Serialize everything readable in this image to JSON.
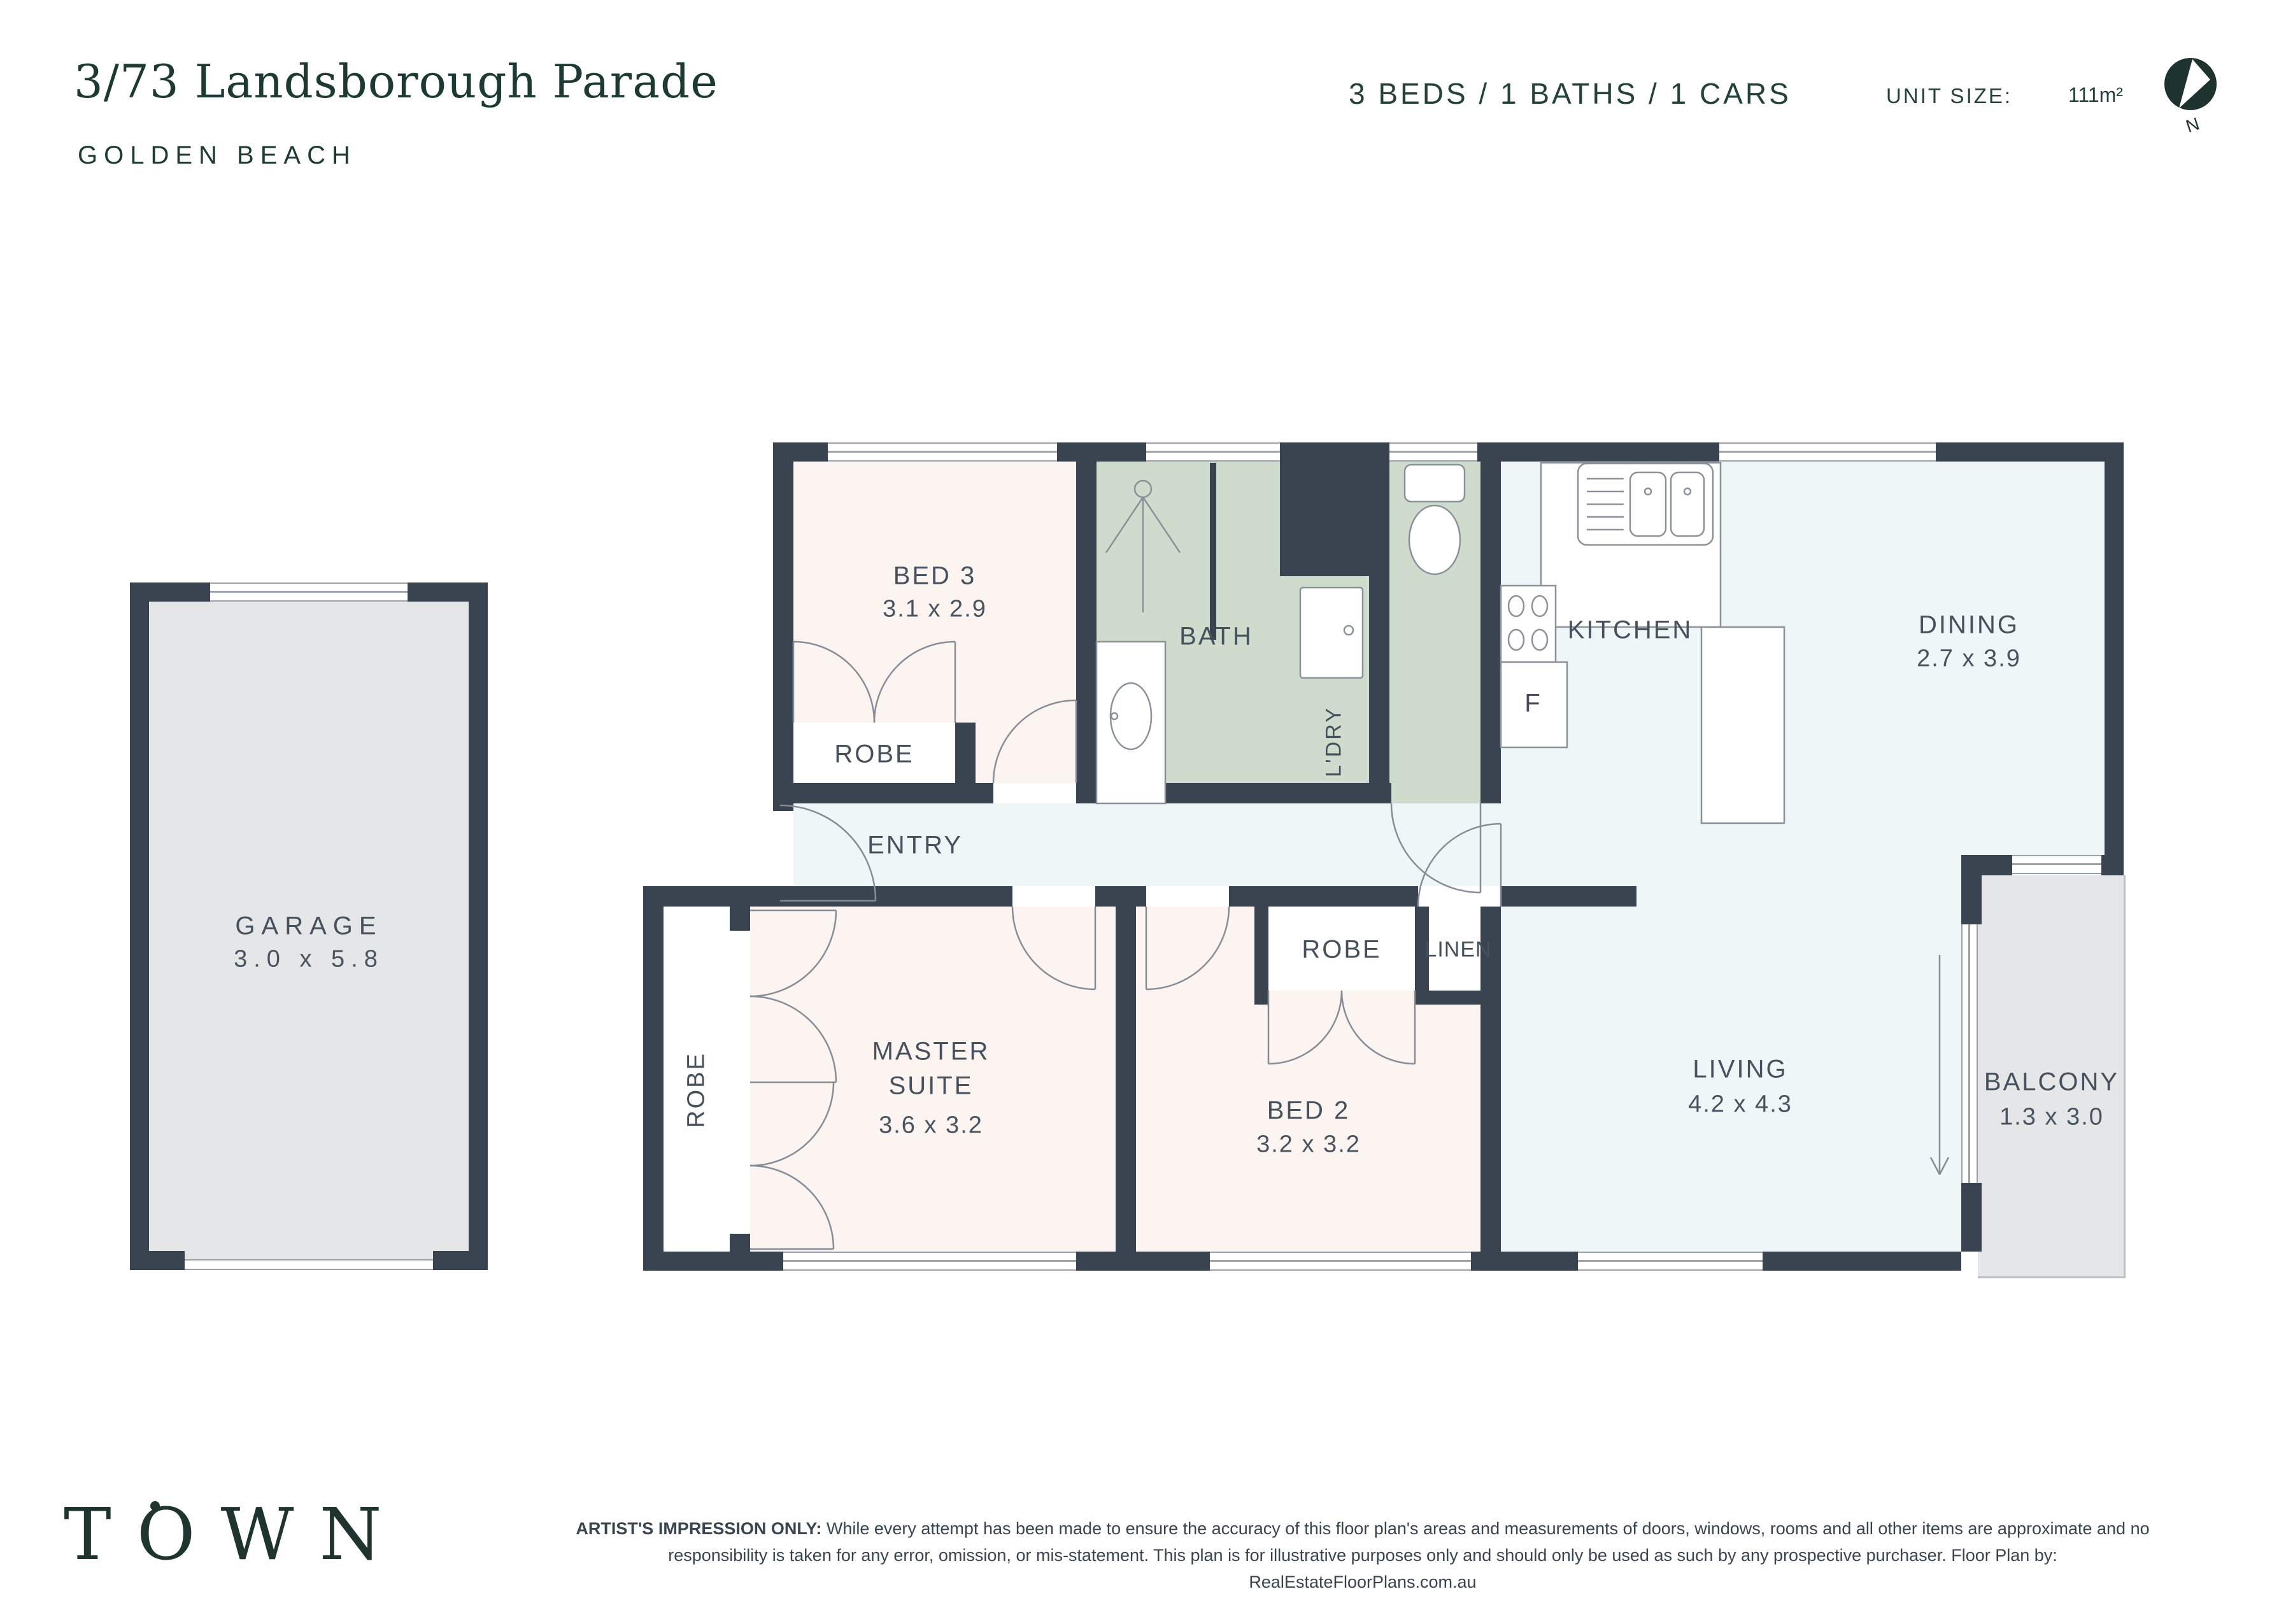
{
  "header": {
    "title": "3/73 Landsborough Parade",
    "suburb": "GOLDEN BEACH",
    "specs": "3 BEDS / 1 BATHS / 1 CARS",
    "unit_size_label": "UNIT SIZE:",
    "unit_size_value": "111m²",
    "compass_label": "N"
  },
  "rooms": {
    "garage": {
      "name": "GARAGE",
      "dims": "3.0 x 5.8"
    },
    "bed3": {
      "name": "BED 3",
      "dims": "3.1 x 2.9"
    },
    "robe_bed3": {
      "name": "ROBE"
    },
    "bath": {
      "name": "BATH"
    },
    "laundry": {
      "name": "L'DRY"
    },
    "kitchen": {
      "name": "KITCHEN"
    },
    "fridge": {
      "name": "F"
    },
    "dining": {
      "name": "DINING",
      "dims": "2.7 x 3.9"
    },
    "entry": {
      "name": "ENTRY"
    },
    "master": {
      "line1": "MASTER",
      "line2": "SUITE",
      "dims": "3.6 x 3.2"
    },
    "robe_master": {
      "name": "ROBE"
    },
    "bed2": {
      "name": "BED 2",
      "dims": "3.2 x 3.2"
    },
    "robe_bed2": {
      "name": "ROBE"
    },
    "linen": {
      "name": "LINEN"
    },
    "living": {
      "name": "LIVING",
      "dims": "4.2 x 4.3"
    },
    "balcony": {
      "name": "BALCONY",
      "dims": "1.3 x 3.0"
    }
  },
  "footer": {
    "logo": "TOWN",
    "disclaimer_bold": "ARTIST'S IMPRESSION ONLY:",
    "disclaimer_line1": " While every attempt has been made to ensure the accuracy of this floor plan's areas and measurements of doors, windows, rooms and all other items are approximate and no",
    "disclaimer_line2": "responsibility is taken for any error, omission, or mis-statement. This plan is for illustrative purposes only and should only be used as such by any prospective purchaser. Floor Plan by: RealEstateFloorPlans.com.au"
  },
  "colors": {
    "brand_green": "#1d3933",
    "wall": "#3a4450",
    "bedroom_fill": "#fbf4f0",
    "living_fill": "#eff6f8",
    "wet_area_fill": "#cfdccd",
    "garage_fill": "#e4e6e7",
    "label_text": "#47515d",
    "fixture_line": "#8a9199"
  }
}
